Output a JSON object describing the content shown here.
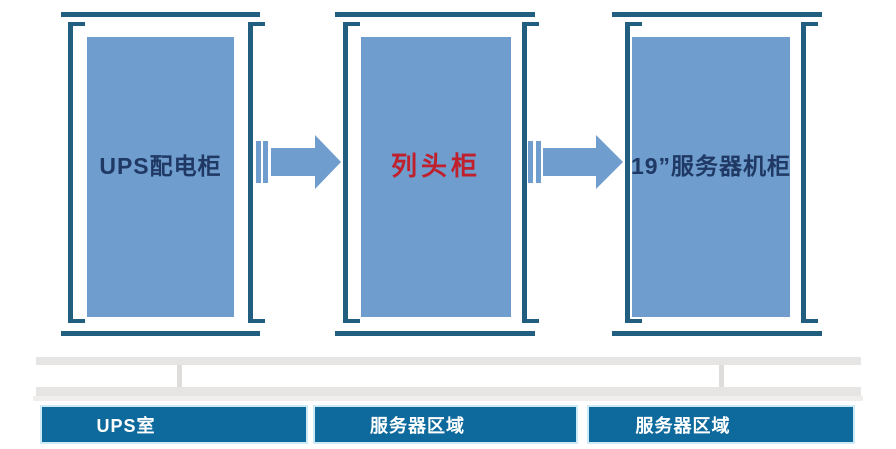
{
  "diagram": {
    "cabinets": [
      {
        "label": "UPS配电柜",
        "label_style": "color:#1f3864"
      },
      {
        "label": "列头柜",
        "label_style": "color:#c0202c"
      },
      {
        "label": "19”服务器机柜",
        "label_style": "color:#1f3864"
      }
    ],
    "zones": [
      {
        "label": "UPS室"
      },
      {
        "label": "服务器区域"
      },
      {
        "label": "服务器区域"
      }
    ],
    "colors": {
      "frame": "#215e80",
      "cabinet_fill": "#6f9dce",
      "arrow": "#6f9dce",
      "zone_fill": "#0e6a9c",
      "zone_border": "#cdeaf6",
      "zone_text": "#ffffff",
      "gray_bar": "#e6e5e3",
      "label_dark": "#1f3864",
      "label_red": "#c0202c"
    }
  }
}
